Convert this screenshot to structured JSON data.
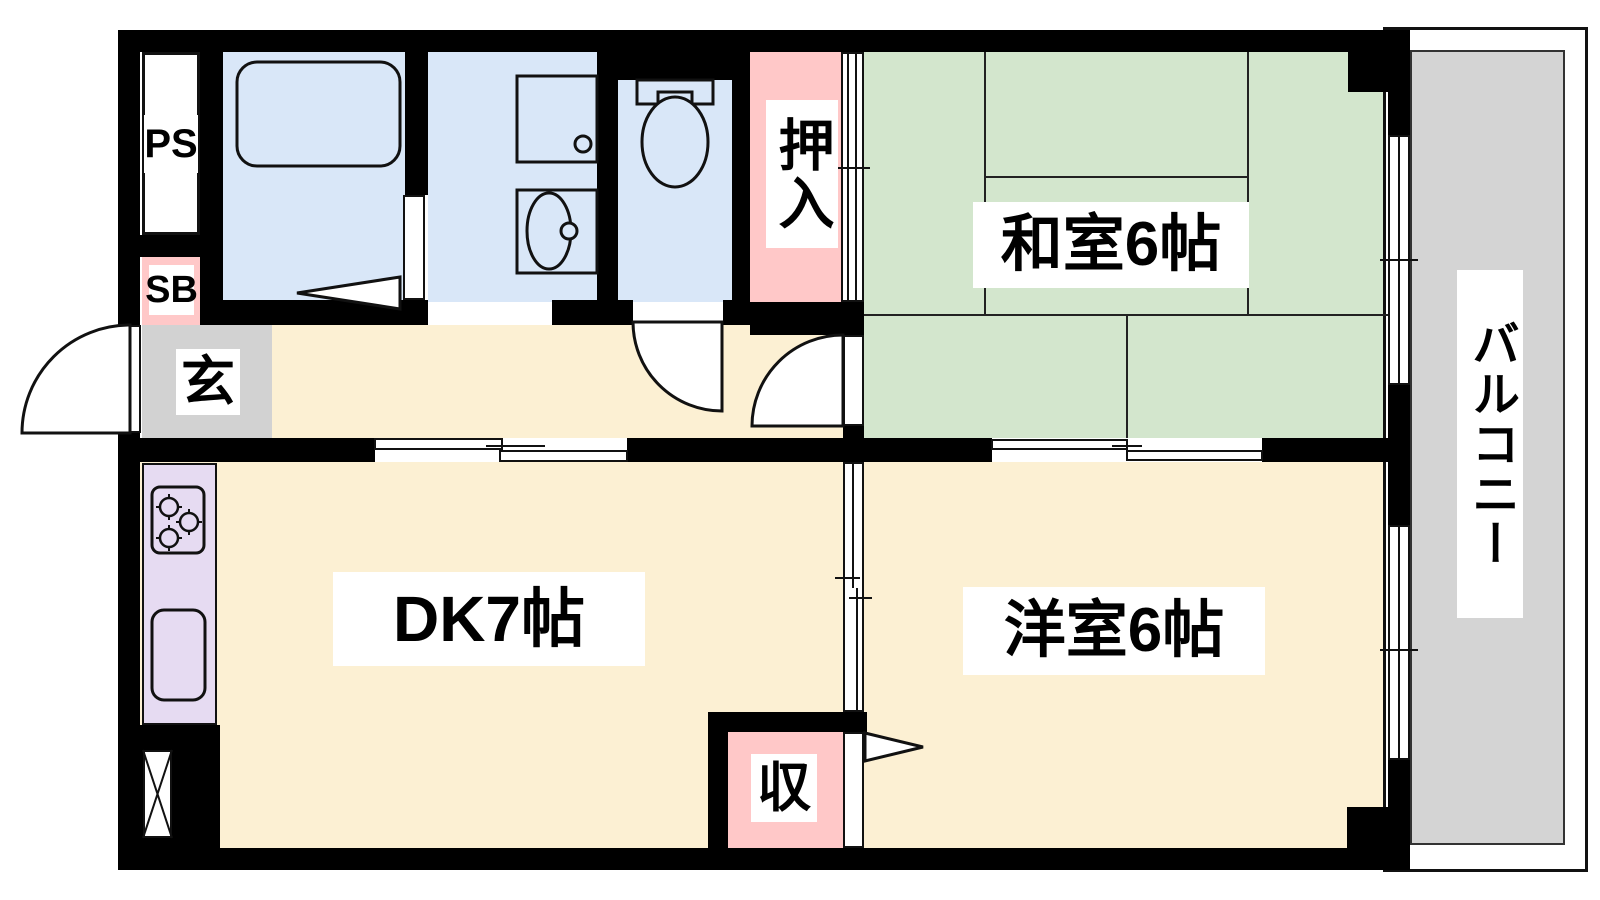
{
  "title": "apartment-floor-plan",
  "colors": {
    "wall": "#000000",
    "tatami_room_green": "#d3e6cd",
    "floor_cream": "#fcf0d3",
    "wet_area_blue": "#d9e7f8",
    "closet_pink": "#ffc8c8",
    "kitchen_counter_lavender": "#e6dbf2",
    "entry_gray": "#d2d2d2",
    "balcony_gray": "#d4d4d4"
  },
  "rooms": {
    "japanese_room": {
      "label": "和室6帖"
    },
    "dining_kitchen": {
      "label": "DK7帖"
    },
    "western_room": {
      "label": "洋室6帖"
    },
    "balcony": {
      "label": "バルコニー"
    },
    "closet_oshiire": {
      "label": "押入"
    },
    "entrance": {
      "label": "玄"
    },
    "storage": {
      "label": "収"
    },
    "pipe_space": {
      "label": "PS"
    },
    "shoe_box": {
      "label": "SB"
    }
  }
}
